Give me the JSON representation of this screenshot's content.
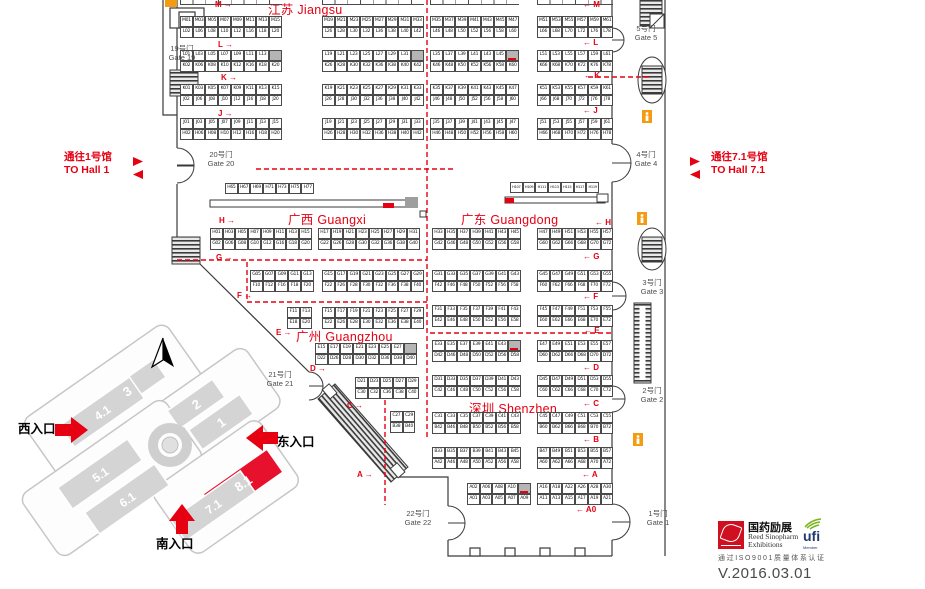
{
  "titles": {
    "jiangsu": "江苏 Jiangsu",
    "guangxi": "广西 Guangxi",
    "guangdong": "广东 Guangdong",
    "guangzhou": "广州 Guangzhou",
    "shenzhen": "深圳 Shenzhen"
  },
  "nav": {
    "to_hall1_cn": "通往1号馆",
    "to_hall1_en": "TO Hall 1",
    "to_hall71_cn": "通往7.1号馆",
    "to_hall71_en": "TO Hall 7.1"
  },
  "colors": {
    "accent": "#e60012",
    "hall_red": "#e8112d",
    "hall_gray": "#d4d4d4"
  },
  "gates": [
    {
      "cn": "19号门",
      "en": "Gate 19",
      "x": 158,
      "y": 44,
      "w": 48
    },
    {
      "cn": "20号门",
      "en": "Gate 20",
      "x": 196,
      "y": 150,
      "w": 50
    },
    {
      "cn": "21号门",
      "en": "Gate 21",
      "x": 256,
      "y": 370,
      "w": 48
    },
    {
      "cn": "22号门",
      "en": "Gate 22",
      "x": 394,
      "y": 509,
      "w": 48
    },
    {
      "cn": "5号门",
      "en": "Gate 5",
      "x": 624,
      "y": 24,
      "w": 44
    },
    {
      "cn": "4号门",
      "en": "Gate 4",
      "x": 624,
      "y": 150,
      "w": 44
    },
    {
      "cn": "3号门",
      "en": "Gate 3",
      "x": 630,
      "y": 278,
      "w": 44
    },
    {
      "cn": "2号门",
      "en": "Gate 2",
      "x": 630,
      "y": 386,
      "w": 44
    },
    {
      "cn": "1号门",
      "en": "Gate 1",
      "x": 636,
      "y": 509,
      "w": 44
    }
  ],
  "markers": [
    {
      "t": "M",
      "s": "l",
      "x": 215,
      "y": 1
    },
    {
      "t": "L",
      "s": "l",
      "x": 218,
      "y": 41
    },
    {
      "t": "K",
      "s": "l",
      "x": 221,
      "y": 74
    },
    {
      "t": "J",
      "s": "l",
      "x": 218,
      "y": 110
    },
    {
      "t": "H",
      "s": "l",
      "x": 219,
      "y": 217
    },
    {
      "t": "G",
      "s": "l",
      "x": 216,
      "y": 254
    },
    {
      "t": "F",
      "s": "l",
      "x": 237,
      "y": 292
    },
    {
      "t": "E",
      "s": "l",
      "x": 276,
      "y": 329
    },
    {
      "t": "D",
      "s": "l",
      "x": 310,
      "y": 365
    },
    {
      "t": "C",
      "s": "l",
      "x": 347,
      "y": 402
    },
    {
      "t": "A",
      "s": "l",
      "x": 357,
      "y": 471
    },
    {
      "t": "M",
      "s": "r",
      "x": 583,
      "y": 1
    },
    {
      "t": "L",
      "s": "r",
      "x": 583,
      "y": 39
    },
    {
      "t": "K",
      "s": "r",
      "x": 584,
      "y": 72
    },
    {
      "t": "J",
      "s": "r",
      "x": 583,
      "y": 107
    },
    {
      "t": "H",
      "s": "r",
      "x": 595,
      "y": 219
    },
    {
      "t": "G",
      "s": "r",
      "x": 583,
      "y": 253
    },
    {
      "t": "F",
      "s": "r",
      "x": 583,
      "y": 293
    },
    {
      "t": "E",
      "s": "r",
      "x": 584,
      "y": 327
    },
    {
      "t": "D",
      "s": "r",
      "x": 583,
      "y": 364
    },
    {
      "t": "C",
      "s": "r",
      "x": 583,
      "y": 400
    },
    {
      "t": "B",
      "s": "r",
      "x": 583,
      "y": 436
    },
    {
      "t": "A",
      "s": "r",
      "x": 582,
      "y": 471
    },
    {
      "t": "A0",
      "s": "r",
      "x": 576,
      "y": 506
    }
  ],
  "strips": [
    [
      180,
      102
    ],
    [
      322,
      102
    ],
    [
      430,
      89
    ],
    [
      537,
      76
    ]
  ],
  "blocks": [
    {
      "x": 180,
      "y": 16,
      "rows": [
        "M01 M03 M05 M07 M09 M11 M13 M15",
        "L02 L06 L08 L10 L12 L16 L18 L20"
      ]
    },
    {
      "x": 322,
      "y": 16,
      "rows": [
        "M19 M21 M23 M25 M27 M29 M31 M33",
        "L26 L28 L30 L32 L36 L38 L40 L42"
      ]
    },
    {
      "x": 430,
      "y": 16,
      "rows": [
        "M35 M37 M39 M41 M43 M45 M47",
        "L46 L48 L50 L52 L56 L58 L60"
      ]
    },
    {
      "x": 537,
      "y": 16,
      "rows": [
        "M51 M53 M55 M57 M59 M61",
        "L66 L68 L70 L72 L76 L78"
      ]
    },
    {
      "x": 180,
      "y": 50,
      "rows": [
        "L01 L03 L05 L07 L09 L11 L13 *",
        "K02 K06 K08 K10 K12 K16 K18 K20"
      ]
    },
    {
      "x": 322,
      "y": 50,
      "rows": [
        "L19 L21 L23 L25 L27 L29 L31 *",
        "K26 K28 K30 K32 K36 K38 K40 K42"
      ]
    },
    {
      "x": 430,
      "y": 50,
      "rows": [
        "L35 L37 L39 L41 L43 L45 *!",
        "K46 K48 K50 K52 K56 K58 K60"
      ]
    },
    {
      "x": 537,
      "y": 50,
      "rows": [
        "L51 L53 L55 L57 L59 L61",
        "K66 K68 K70 K72 K76 K78"
      ]
    },
    {
      "x": 180,
      "y": 84,
      "rows": [
        "K01 K03 K05 K07 K09 K11 K13 K15",
        "J02 J06 J08 J10 J12 J16 J18 J20"
      ]
    },
    {
      "x": 322,
      "y": 84,
      "rows": [
        "K19 K21 K23 K25 K27 K29 K31 K33",
        "J26 J28 J30 J32 J36 J38 J40 J42"
      ]
    },
    {
      "x": 430,
      "y": 84,
      "rows": [
        "K35 K37 K39 K41 K43 K45 K47",
        "J46 J48 J50 J52 J56 J58 J60"
      ]
    },
    {
      "x": 537,
      "y": 84,
      "rows": [
        "K51 K53 K55 K57 K59 K61",
        "J66 J68 J70 J72 J76 J78"
      ]
    },
    {
      "x": 180,
      "y": 118,
      "rows": [
        "J01 J03 J05 J07 J09 J11 J13 J15",
        "H02 H06 H08 H10 H12 H16 H18 H20"
      ]
    },
    {
      "x": 322,
      "y": 118,
      "rows": [
        "J19 J21 J23 J25 J27 J29 J31 J33",
        "H26 H28 H30 H32 H36 H38 H40 H42"
      ]
    },
    {
      "x": 430,
      "y": 118,
      "rows": [
        "J35 J37 J39 J41 J43 J45 J47",
        "H46 H48 H50 H52 H56 H58 H60"
      ]
    },
    {
      "x": 537,
      "y": 118,
      "rows": [
        "J51 J53 J55 J57 J59 J61",
        "H66 H68 H70 H72 H76 H78"
      ]
    },
    {
      "x": 225,
      "y": 183,
      "rows": [
        "H65 H67 H69 H71 H73 H75 H77"
      ]
    },
    {
      "x": 510,
      "y": 182,
      "small": true,
      "rows": [
        "H107 H109 H111 H113 H115 H117 H119"
      ]
    },
    {
      "x": 210,
      "y": 228,
      "rows": [
        "H01 H03 H05 H07 H09 H11 H13 H15",
        "G02 G06 G08 G10 G12 G16 G18 G20"
      ]
    },
    {
      "x": 318,
      "y": 228,
      "rows": [
        "H17 H19 H21 H23 H25 H27 H29 H31",
        "G22 G26 G28 G30 G32 G36 G38 G40"
      ]
    },
    {
      "x": 432,
      "y": 228,
      "rows": [
        "H33 H35 H37 H39 H41 H43 H45",
        "G42 G46 G48 G50 G52 G56 G58"
      ]
    },
    {
      "x": 537,
      "y": 228,
      "rows": [
        "H47 H49 H51 H53 H55 H57",
        "G60 G62 G66 G68 G70 G72"
      ]
    },
    {
      "x": 250,
      "y": 270,
      "rows": [
        "G05 G07 G09 G11 G13",
        "F10 F12 F16 F18 F20"
      ]
    },
    {
      "x": 322,
      "y": 270,
      "rows": [
        "G15 G17 G19 G21 G23 G25 G27 G29",
        "F22 F26 F28 F30 F32 F36 F38 F40"
      ]
    },
    {
      "x": 432,
      "y": 270,
      "rows": [
        "G31 G33 G35 G37 G39 G41 G43",
        "F42 F46 F48 F50 F52 F56 F58"
      ]
    },
    {
      "x": 537,
      "y": 270,
      "rows": [
        "G45 G47 G49 G51 G53 G55",
        "F60 F62 F66 F68 F70 F72"
      ]
    },
    {
      "x": 287,
      "y": 307,
      "rows": [
        "F11 F13",
        "E18 E20"
      ]
    },
    {
      "x": 322,
      "y": 307,
      "rows": [
        "F15 F17 F19 F21 F23 F25 F27 F29",
        "E22 E26 E28 E30 E32 E36 E38 E40"
      ]
    },
    {
      "x": 432,
      "y": 305,
      "rows": [
        "F31 F33 F35 F37 F39 F41 F43",
        "E42 E46 E48 E50 E52 E56 E58"
      ]
    },
    {
      "x": 537,
      "y": 305,
      "rows": [
        "F45 F47 F49 F51 F53 F55",
        "E60 E62 E66 E68 E70 E72"
      ]
    },
    {
      "x": 315,
      "y": 343,
      "rows": [
        "E15 E17 E19 E21 E23 E25 E27 *",
        "D22 D26 D28 D30 D32 D36 D38 D40"
      ]
    },
    {
      "x": 432,
      "y": 340,
      "rows": [
        "E33 E35 E37 E39 E41 E43 *!",
        "D42 D46 D48 D50 D52 D56 D58"
      ]
    },
    {
      "x": 537,
      "y": 340,
      "rows": [
        "E47 E49 E51 E53 E55 E57",
        "D60 D62 D66 D68 D70 D72"
      ]
    },
    {
      "x": 355,
      "y": 377,
      "rows": [
        "D21 D23 D25 D27 D29",
        "C30 C32 C36 C38 C40"
      ]
    },
    {
      "x": 432,
      "y": 375,
      "rows": [
        "D31 D33 D35 D37 D39 D41 D43",
        "C42 C46 C48 C50 C52 C56 C58"
      ]
    },
    {
      "x": 537,
      "y": 375,
      "rows": [
        "D45 D47 D49 D51 D53 D55",
        "C60 C62 C66 C68 C70 C72"
      ]
    },
    {
      "x": 390,
      "y": 411,
      "rows": [
        "C27 C29",
        "B38 B40"
      ]
    },
    {
      "x": 432,
      "y": 412,
      "rows": [
        "C31 C33 C35 C37 C39 C41 C43",
        "B42 B46 B48 B50 B52 B56 B58"
      ]
    },
    {
      "x": 537,
      "y": 412,
      "rows": [
        "C45 C47 C49 C51 C53 C55",
        "B60 B62 B66 B68 B70 B72"
      ]
    },
    {
      "x": 432,
      "y": 447,
      "rows": [
        "B33 B35 B37 B39 B41 B43 B45",
        "A42 A46 A48 A50 A52 A56 A58"
      ]
    },
    {
      "x": 537,
      "y": 447,
      "rows": [
        "B47 B49 B51 B53 B55 B57",
        "A60 A62 A66 A68 A70 A72"
      ]
    },
    {
      "x": 467,
      "y": 483,
      "rows": [
        "A02 A06 A08 A10 *!",
        "A01 A03 A05 A07 A09"
      ]
    },
    {
      "x": 537,
      "y": 483,
      "rows": [
        "A16 A18 A22 A26 A28 A30",
        "A11 A13 A15 A17 A19 A21"
      ]
    }
  ],
  "minimap": {
    "halls": [
      {
        "label": "3"
      },
      {
        "label": "4.1"
      },
      {
        "label": "2"
      },
      {
        "label": "1"
      },
      {
        "label": "5.1"
      },
      {
        "label": "6.1"
      },
      {
        "label": "8.1"
      },
      {
        "label": "7.1"
      }
    ],
    "highlighted": "8.1",
    "entrances": {
      "west": "西入口",
      "east": "东入口",
      "south": "南入口"
    }
  },
  "footer": {
    "logo_cn": "国药励展",
    "logo_en1": "Reed Sinopharm",
    "logo_en2": "Exhibitions",
    "ufi": "ufi",
    "ufi_sub": "Member",
    "iso": "通过ISO9001质量体系认证",
    "version": "V.2016.03.01"
  }
}
